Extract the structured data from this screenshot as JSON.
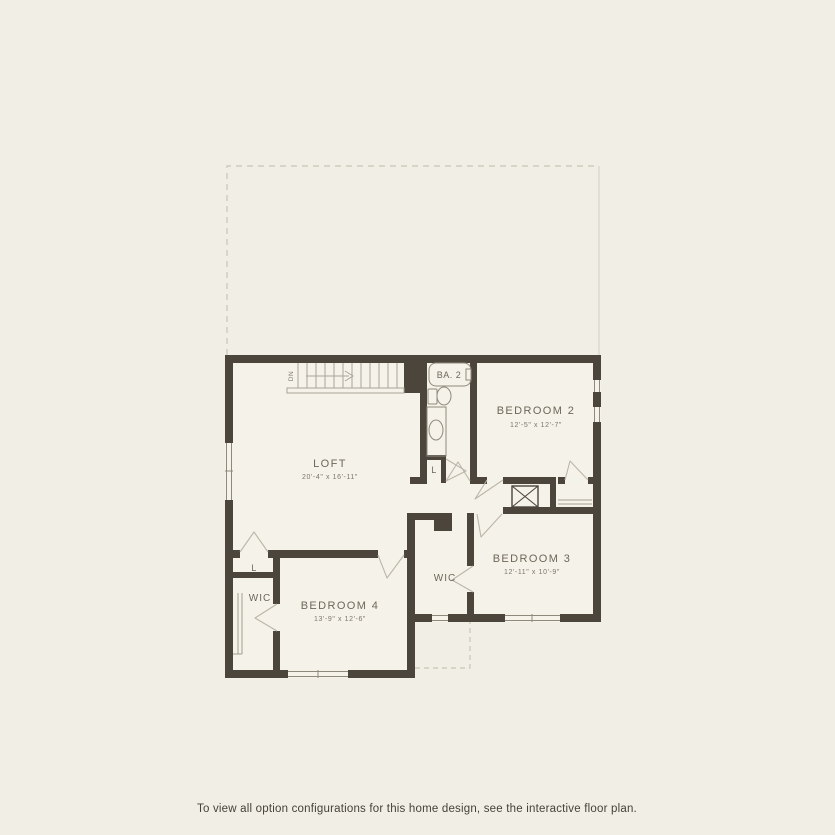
{
  "meta": {
    "caption": "To view all option configurations for this home design, see the interactive floor plan."
  },
  "colors": {
    "bg": "#f1efe5",
    "floor": "#f5f2e9",
    "wall": "#4c453c",
    "line": "#8f897c",
    "door": "#bcb6a8",
    "shelf": "#a49e90",
    "stair": "#aaa496",
    "dash": "#c9c5b7",
    "text": "#6e6759",
    "caption": "#46413a"
  },
  "floorplan": {
    "rooms": {
      "loft": {
        "name": "LOFT",
        "dims": "20'-4\" x 16'-11\""
      },
      "bedroom2": {
        "name": "BEDROOM 2",
        "dims": "12'-5\" x 12'-7\""
      },
      "bedroom3": {
        "name": "BEDROOM 3",
        "dims": "12'-11\" x 10'-9\""
      },
      "bedroom4": {
        "name": "BEDROOM 4",
        "dims": "13'-9\" x 12'-6\""
      },
      "bath2": {
        "name": "BA. 2"
      },
      "wic_center": {
        "label": "WIC"
      },
      "wic_left": {
        "label": "WIC"
      },
      "linen_left": {
        "label": "L"
      },
      "linen_bath": {
        "label": "L"
      }
    },
    "stairs": {
      "label": "DN"
    }
  }
}
